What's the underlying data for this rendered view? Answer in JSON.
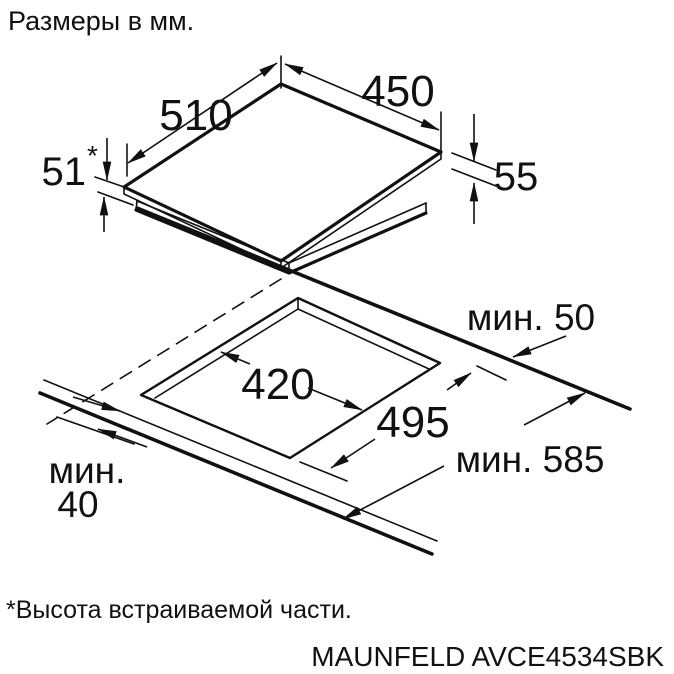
{
  "title": "Размеры в мм.",
  "footnote": "*Высота встраиваемой части.",
  "model": "MAUNFELD AVCE4534SBK",
  "colors": {
    "line": "#111111",
    "text": "#111111",
    "background": "#ffffff"
  },
  "top_view": {
    "depth": "510",
    "width": "450",
    "builtin_height": "51",
    "builtin_height_mark": "*",
    "total_height": "55"
  },
  "cutout_view": {
    "cutout_depth": "420",
    "cutout_width": "495",
    "min_back_clearance": "мин. 50",
    "min_side_clearance": "мин. 585",
    "min_front_line1": "мин.",
    "min_front_line2": "40"
  }
}
